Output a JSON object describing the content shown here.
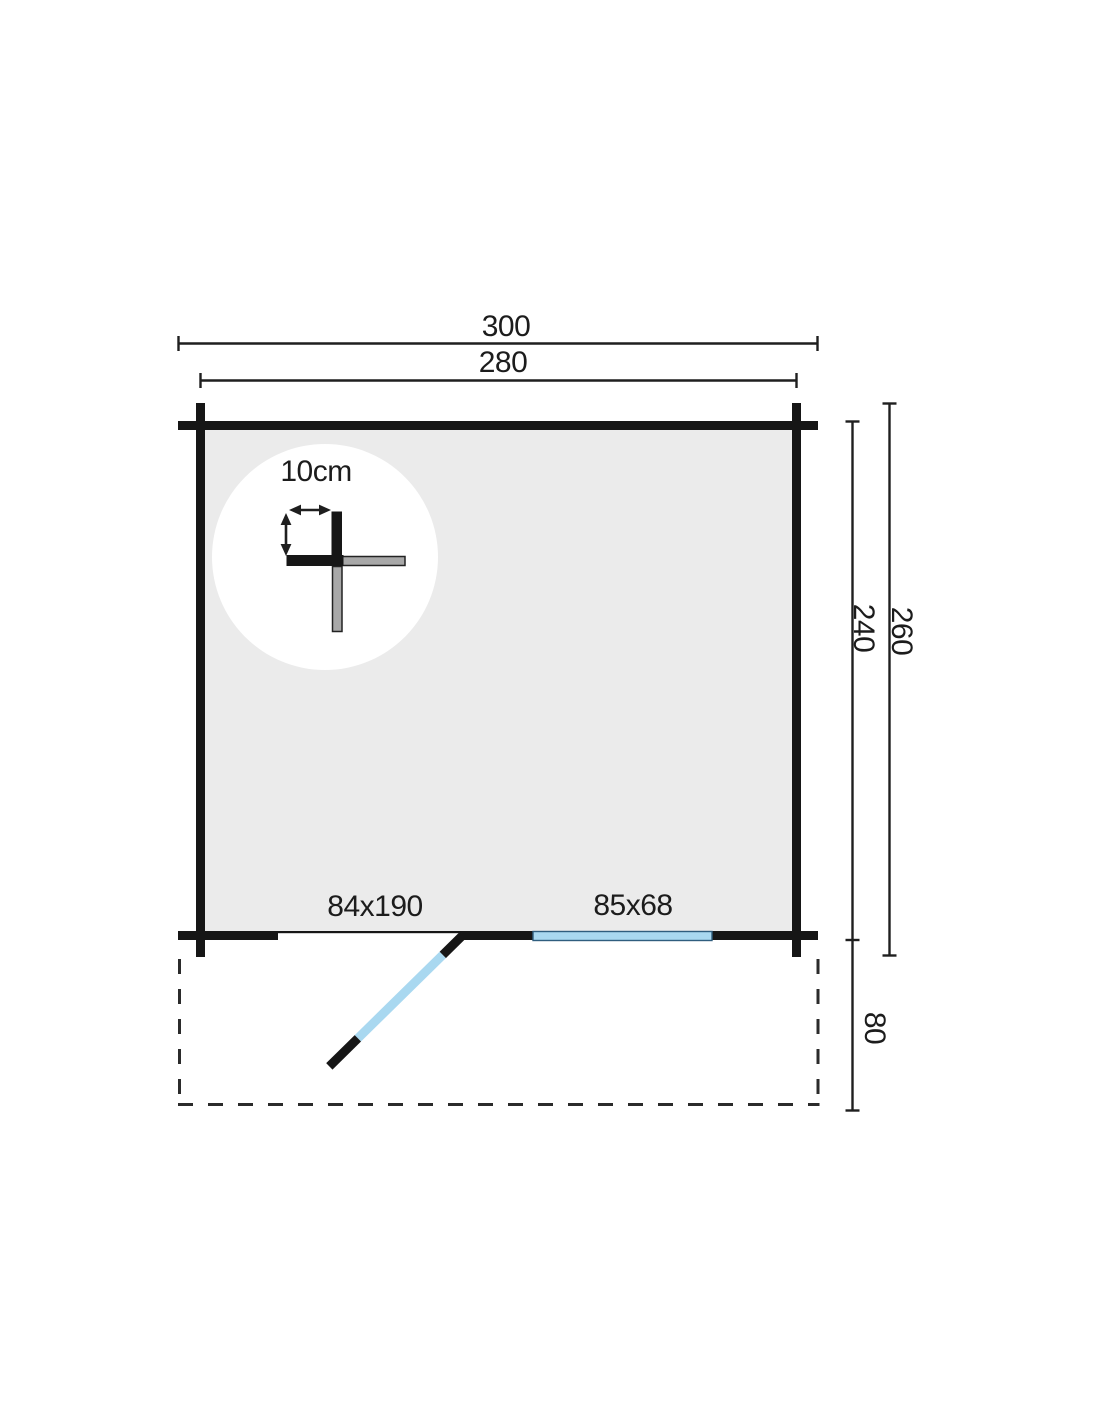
{
  "plan": {
    "type": "log-cabin-floor-plan",
    "dimensions": {
      "width_outer": "300",
      "width_inner": "280",
      "depth_inner": "240",
      "depth_outer": "260",
      "terrace_depth": "80"
    },
    "openings": {
      "door_label": "84x190",
      "window_label": "85x68"
    },
    "detail": {
      "log_spacing_label": "10cm"
    },
    "colors": {
      "wall_black": "#161616",
      "floor_gray": "#ebebeb",
      "glass_blue": "#a9d8f0",
      "log_gray": "#a8a8a8",
      "line_dark": "#1f1f1f"
    }
  }
}
